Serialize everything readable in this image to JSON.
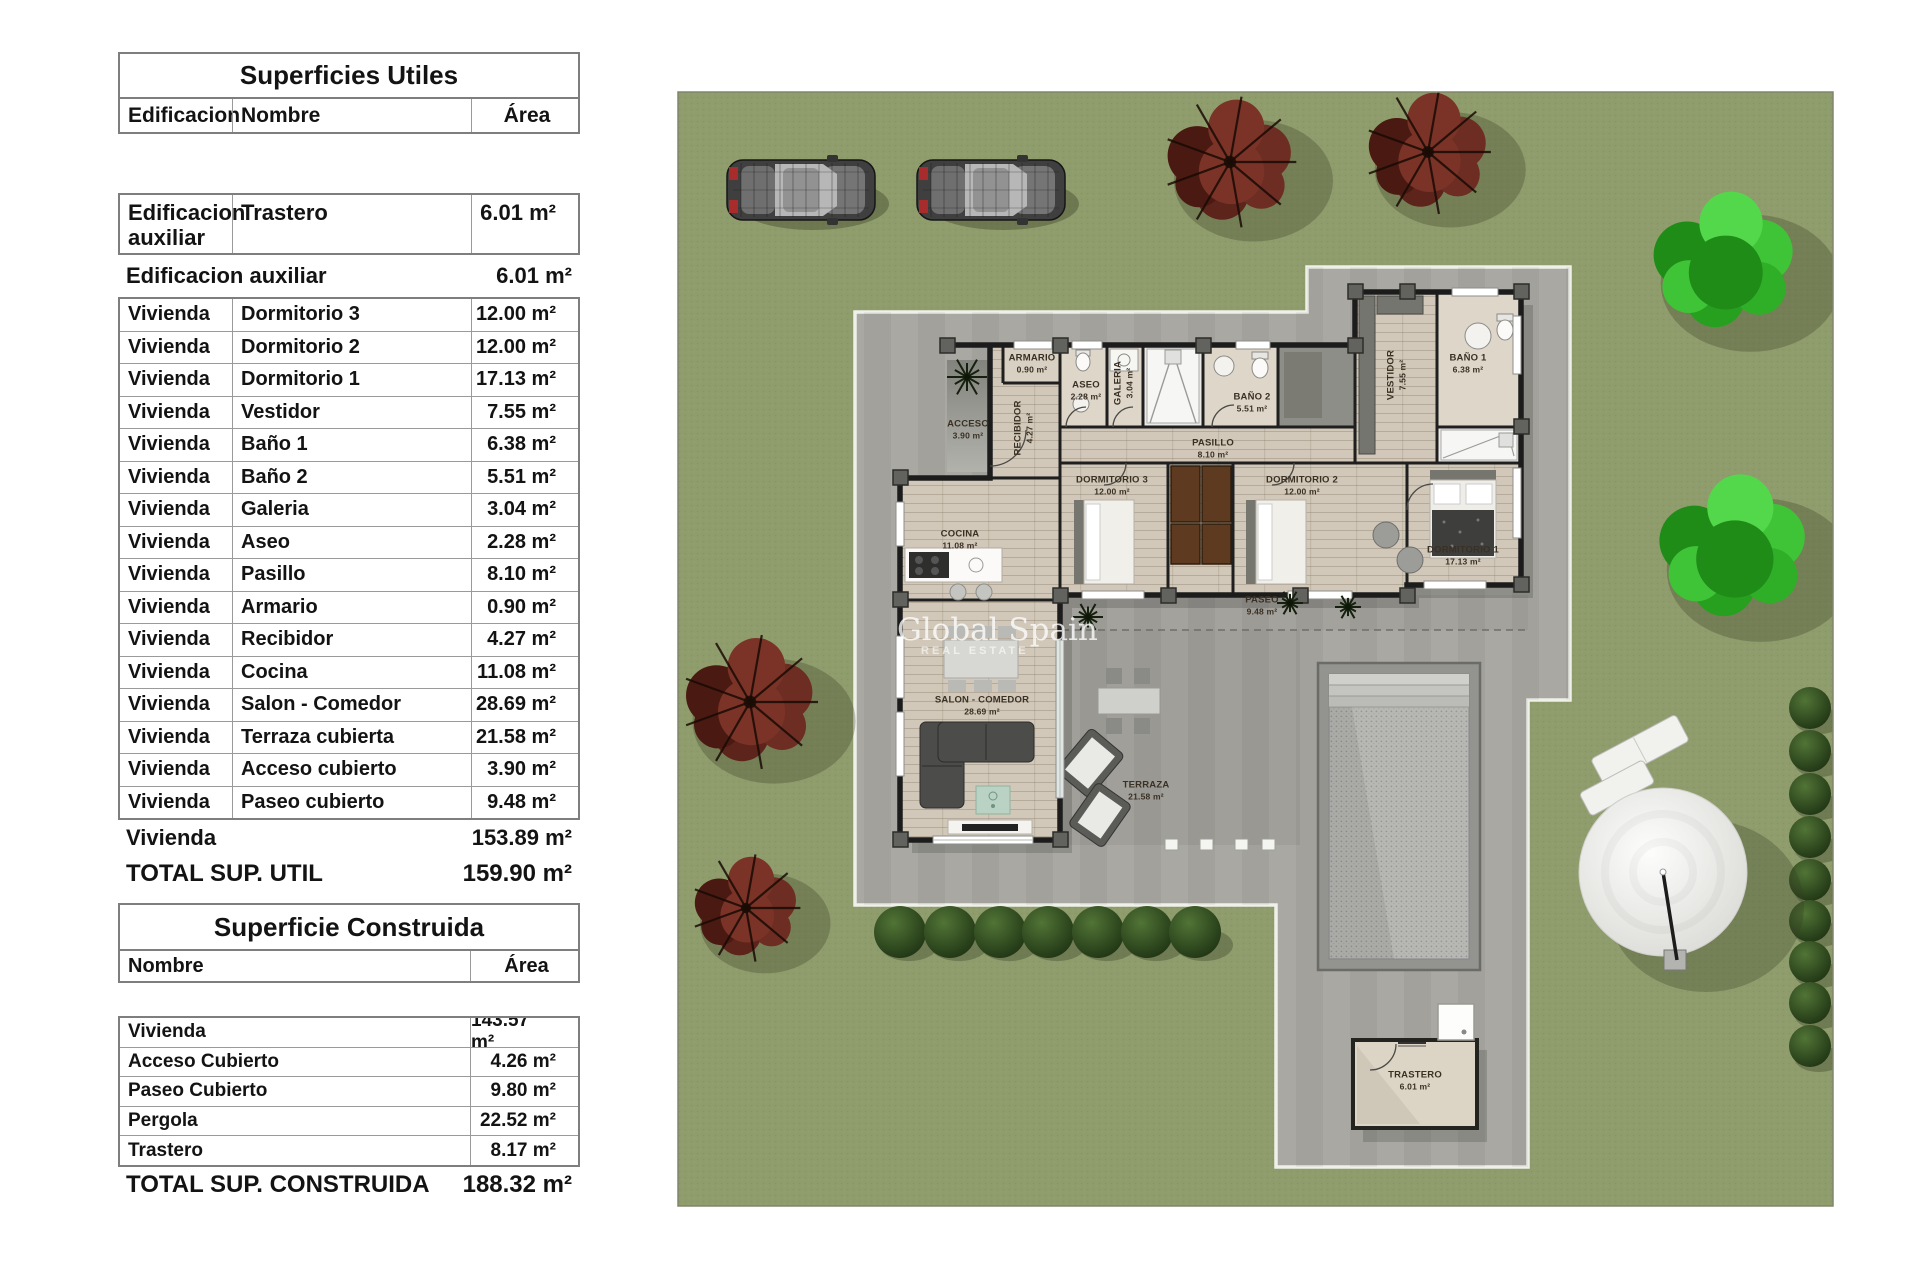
{
  "tables": {
    "utiles": {
      "title": "Superficies Utiles",
      "columns": [
        "Edificacion",
        "Nombre",
        "Área"
      ],
      "first_row": {
        "edificacion": "Edificacion auxiliar",
        "nombre": "Trastero",
        "area": "6.01 m²"
      },
      "subtotal_aux": {
        "label": "Edificacion auxiliar",
        "area": "6.01 m²"
      },
      "rows": [
        {
          "edificacion": "Vivienda",
          "nombre": "Dormitorio 3",
          "area": "12.00 m²"
        },
        {
          "edificacion": "Vivienda",
          "nombre": "Dormitorio 2",
          "area": "12.00 m²"
        },
        {
          "edificacion": "Vivienda",
          "nombre": "Dormitorio 1",
          "area": "17.13 m²"
        },
        {
          "edificacion": "Vivienda",
          "nombre": "Vestidor",
          "area": "7.55 m²"
        },
        {
          "edificacion": "Vivienda",
          "nombre": "Baño 1",
          "area": "6.38 m²"
        },
        {
          "edificacion": "Vivienda",
          "nombre": "Baño 2",
          "area": "5.51 m²"
        },
        {
          "edificacion": "Vivienda",
          "nombre": "Galeria",
          "area": "3.04 m²"
        },
        {
          "edificacion": "Vivienda",
          "nombre": "Aseo",
          "area": "2.28 m²"
        },
        {
          "edificacion": "Vivienda",
          "nombre": "Pasillo",
          "area": "8.10 m²"
        },
        {
          "edificacion": "Vivienda",
          "nombre": "Armario",
          "area": "0.90 m²"
        },
        {
          "edificacion": "Vivienda",
          "nombre": "Recibidor",
          "area": "4.27 m²"
        },
        {
          "edificacion": "Vivienda",
          "nombre": "Cocina",
          "area": "11.08 m²"
        },
        {
          "edificacion": "Vivienda",
          "nombre": "Salon - Comedor",
          "area": "28.69 m²"
        },
        {
          "edificacion": "Vivienda",
          "nombre": "Terraza cubierta",
          "area": "21.58 m²"
        },
        {
          "edificacion": "Vivienda",
          "nombre": "Acceso cubierto",
          "area": "3.90 m²"
        },
        {
          "edificacion": "Vivienda",
          "nombre": "Paseo cubierto",
          "area": "9.48 m²"
        }
      ],
      "subtotal_vivienda": {
        "label": "Vivienda",
        "area": "153.89 m²"
      },
      "total": {
        "label": "TOTAL SUP. UTIL",
        "area": "159.90 m²"
      }
    },
    "construida": {
      "title": "Superficie Construida",
      "columns": [
        "Nombre",
        "Área"
      ],
      "rows": [
        {
          "nombre": "Vivienda",
          "area": "143.57 m²"
        },
        {
          "nombre": "Acceso Cubierto",
          "area": "4.26 m²"
        },
        {
          "nombre": "Paseo Cubierto",
          "area": "9.80 m²"
        },
        {
          "nombre": "Pergola",
          "area": "22.52 m²"
        },
        {
          "nombre": "Trastero",
          "area": "8.17 m²"
        }
      ],
      "total": {
        "label": "TOTAL SUP. CONSTRUIDA",
        "area": "188.32 m²"
      }
    }
  },
  "plan": {
    "watermark": {
      "line1": "Global Spain",
      "line2": "REAL ESTATE"
    },
    "rooms": [
      {
        "name": "ACCESO",
        "area": "3.90 m²"
      },
      {
        "name": "RECIBIDOR",
        "area": "4.27 m²"
      },
      {
        "name": "ARMARIO",
        "area": "0.90 m²"
      },
      {
        "name": "ASEO",
        "area": "2.28 m²"
      },
      {
        "name": "GALERIA",
        "area": "3.04 m²"
      },
      {
        "name": "BAÑO 2",
        "area": "5.51 m²"
      },
      {
        "name": "PASILLO",
        "area": "8.10 m²"
      },
      {
        "name": "DORMITORIO 3",
        "area": "12.00 m²"
      },
      {
        "name": "DORMITORIO 2",
        "area": "12.00 m²"
      },
      {
        "name": "DORMITORIO 1",
        "area": "17.13 m²"
      },
      {
        "name": "VESTIDOR",
        "area": "7.55 m²"
      },
      {
        "name": "BAÑO 1",
        "area": "6.38 m²"
      },
      {
        "name": "COCINA",
        "area": "11.08 m²"
      },
      {
        "name": "SALON - COMEDOR",
        "area": "28.69 m²"
      },
      {
        "name": "TERRAZA",
        "area": "21.58 m²"
      },
      {
        "name": "PASEO",
        "area": "9.48 m²"
      },
      {
        "name": "TRASTERO",
        "area": "6.01 m²"
      }
    ]
  }
}
